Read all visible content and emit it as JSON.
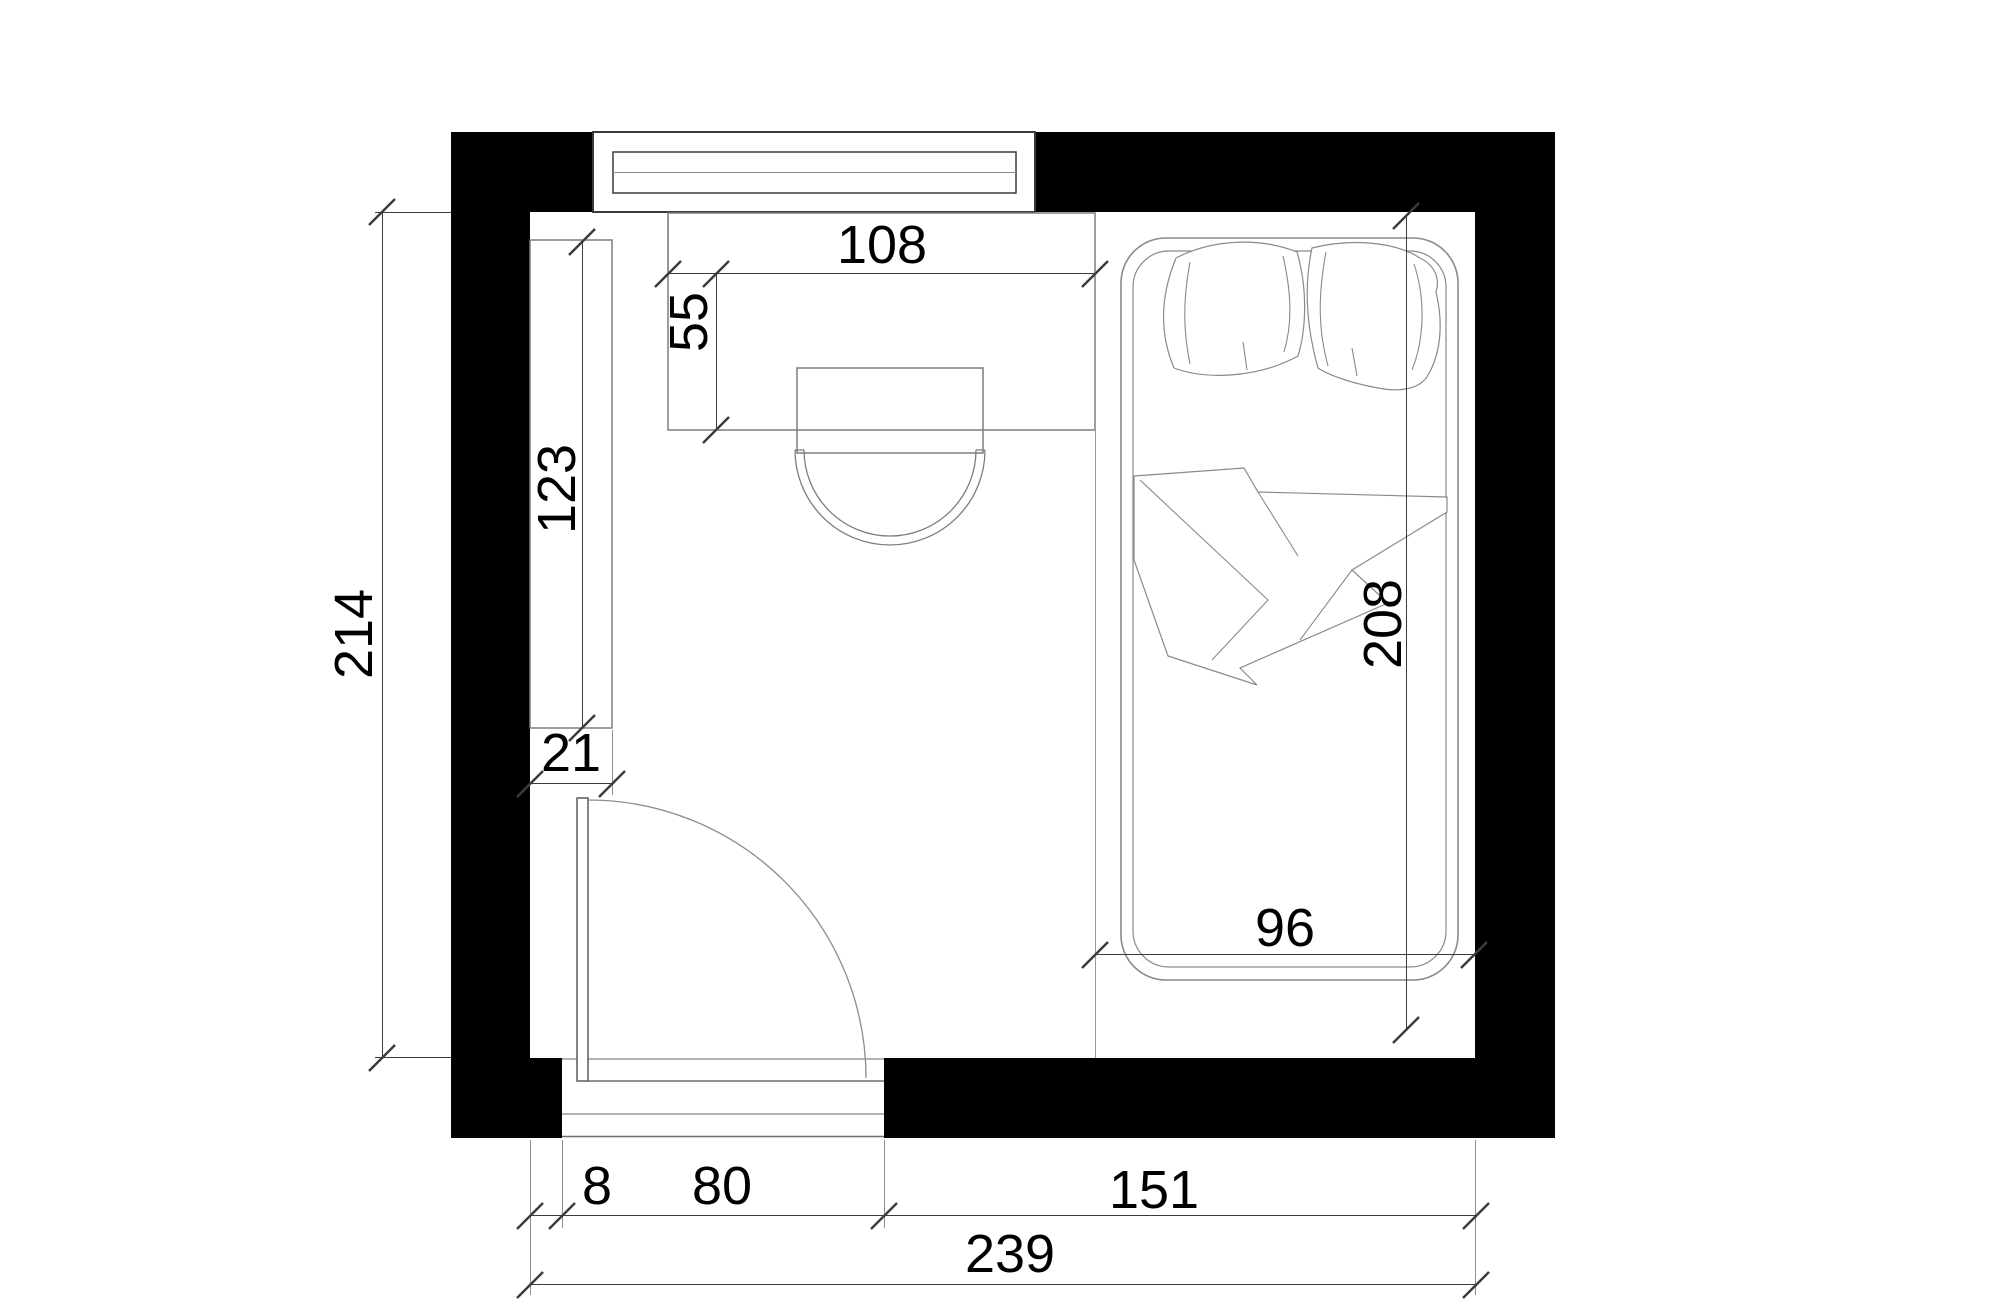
{
  "meta": {
    "drawing_type": "bedroom floor plan",
    "view": "top-down architectural plan",
    "units": "cm"
  },
  "colors": {
    "background": "#ffffff",
    "wall_fill": "#000000",
    "furniture_line": "#7d7d7d",
    "window_line": "#3a3a3a",
    "dimension_line": "#3c3c3c",
    "label_text": "#000000"
  },
  "dimensions": {
    "room_inner_height": "214",
    "room_inner_width": "239",
    "shelf_length": "123",
    "shelf_depth": "21",
    "desk_width": "108",
    "desk_depth": "55",
    "bed_length": "208",
    "bed_width": "96",
    "door_side_offset": "8",
    "door_opening_width": "80",
    "bottom_right_segment": "151"
  },
  "elements": [
    "top-wall",
    "left-wall",
    "right-wall",
    "bottom-wall",
    "window",
    "wardrobe-shelf",
    "desk",
    "chair",
    "door",
    "door-swing-arc",
    "bed",
    "pillows",
    "blanket",
    "door-threshold"
  ]
}
